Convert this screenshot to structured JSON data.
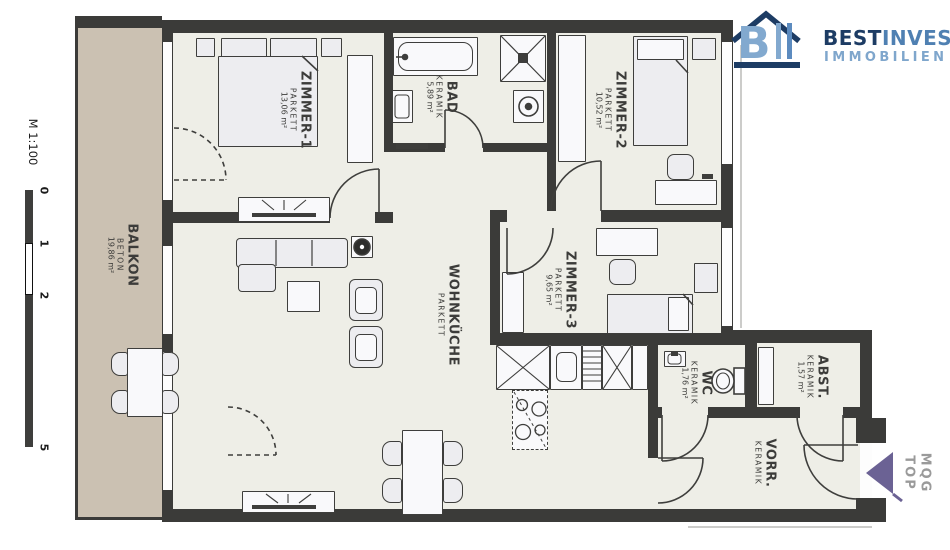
{
  "scale": {
    "label": "M 1:100",
    "ticks": [
      "0",
      "1",
      "2",
      "5"
    ]
  },
  "logo": {
    "mark_letter": "B",
    "name_primary": "BEST",
    "name_secondary": "INVEST",
    "subtitle": "IMMOBILIEN"
  },
  "direction_marker": {
    "line1": "MQG",
    "line2": "TOP"
  },
  "rooms": [
    {
      "id": "zimmer1",
      "name": "ZIMMER-1",
      "floor": "PARKETT",
      "area": "13,06 m²"
    },
    {
      "id": "bad",
      "name": "BAD",
      "floor": "KERAMIK",
      "area": "5,89 m²"
    },
    {
      "id": "zimmer2",
      "name": "ZIMMER-2",
      "floor": "PARKETT",
      "area": "10,52 m²"
    },
    {
      "id": "wohnkueche",
      "name": "WOHNKÜCHE",
      "floor": "PARKETT",
      "area": ""
    },
    {
      "id": "zimmer3",
      "name": "ZIMMER-3",
      "floor": "PARKETT",
      "area": "9,65 m²"
    },
    {
      "id": "balkon",
      "name": "BALKON",
      "floor": "BETON",
      "area": "19,86 m²"
    },
    {
      "id": "wc",
      "name": "WC",
      "floor": "KERAMIK",
      "area": "1,76 m²"
    },
    {
      "id": "abst",
      "name": "ABST.",
      "floor": "KERAMIK",
      "area": "1,57 m²"
    },
    {
      "id": "vorr",
      "name": "VORR.",
      "floor": "KERAMIK",
      "area": ""
    }
  ],
  "colors": {
    "wall": "#3b3b39",
    "floor": "#eeeee7",
    "balcony": "#cbc1b2",
    "logo_dark": "#1d3c64",
    "logo_mid": "#4f80b2",
    "logo_light": "#82a9cf",
    "arrow_purple": "#6b6294",
    "marker_text": "#9a9a9a"
  }
}
